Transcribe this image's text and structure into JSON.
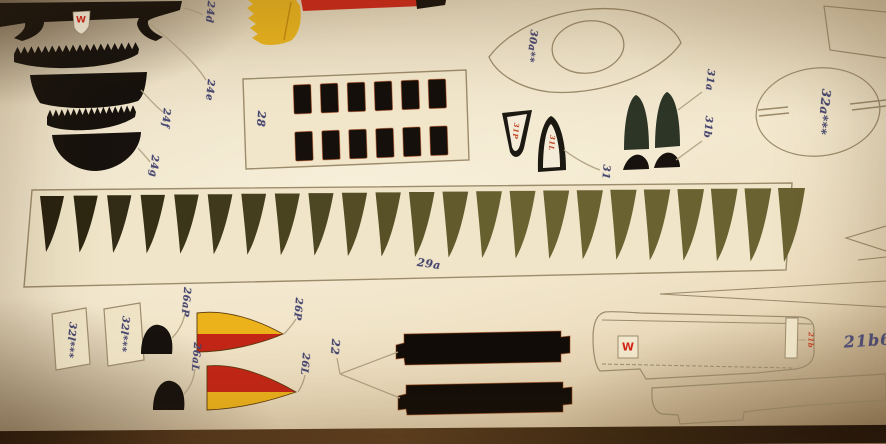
{
  "meta": {
    "description": "Photograph of a printed paper-model parts sheet"
  },
  "emblems": {
    "w_top": "W",
    "w_bottom": "W"
  },
  "labels": {
    "l24d": "24d",
    "l24e": "24e",
    "l24f": "24f",
    "l24g": "24g",
    "l28": "28",
    "l29a": "29a",
    "l30a": "30a**",
    "l31p_red": "31P",
    "l31l_red": "31L",
    "l31": "31",
    "l31a": "31a",
    "l31b": "31b",
    "l32a": "32a***",
    "l32l_a": "32l***",
    "l32l_b": "32l***",
    "l26ap": "26aP",
    "l26p": "26P",
    "l26al": "26aL",
    "l26l": "26L",
    "l22": "22",
    "l21b_red": "21b",
    "l21b_blue": "21b6"
  },
  "colors": {
    "paper": "#efe3c6",
    "label_ink": "#46466f",
    "part_black": "#17120d",
    "fin_dark": "#282210",
    "fin_olive": "#6a6230",
    "yellow": "#e9b41f",
    "red": "#c62a16",
    "red_text": "#c24526",
    "green_dark": "#2c3526",
    "outline": "#9c8c6c",
    "leader": "#b4a486"
  },
  "counts": {
    "strip_29a_fins": 23,
    "grid_28_rows": 2,
    "grid_28_cols": 6,
    "teeth_band_upper": 18,
    "teeth_band_lower": 15
  }
}
